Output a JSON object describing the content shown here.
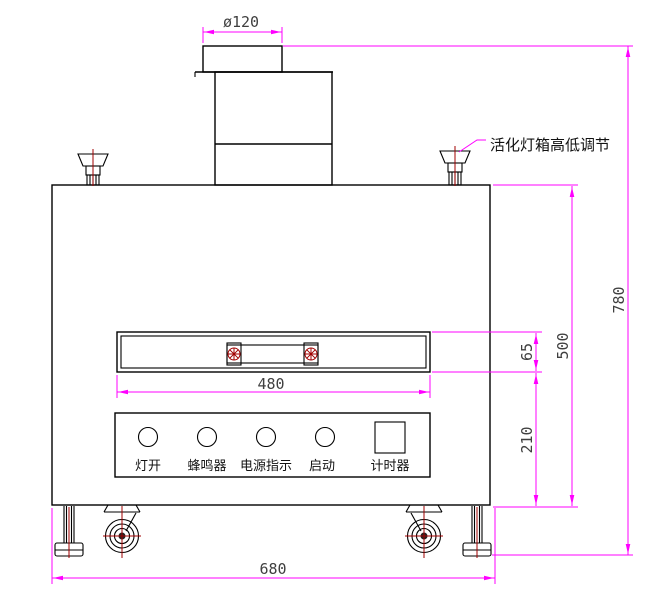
{
  "drawing": {
    "note": "活化灯箱高低调节",
    "panel_labels": {
      "lamp_on": "灯开",
      "buzzer": "蜂鸣器",
      "power_indicator": "电源指示",
      "start": "启动",
      "timer": "计时器"
    },
    "dimensions": {
      "top_diameter": "ø120",
      "total_height": "780",
      "upper_body_height": "500",
      "window_height": "65",
      "lower_section_height": "210",
      "window_width": "480",
      "total_width": "680"
    },
    "colors": {
      "dimension_line": "#ff00ff",
      "outline": "#000000",
      "centerline_red": "#a00000",
      "dimension_text": "#3f3f3f"
    }
  }
}
